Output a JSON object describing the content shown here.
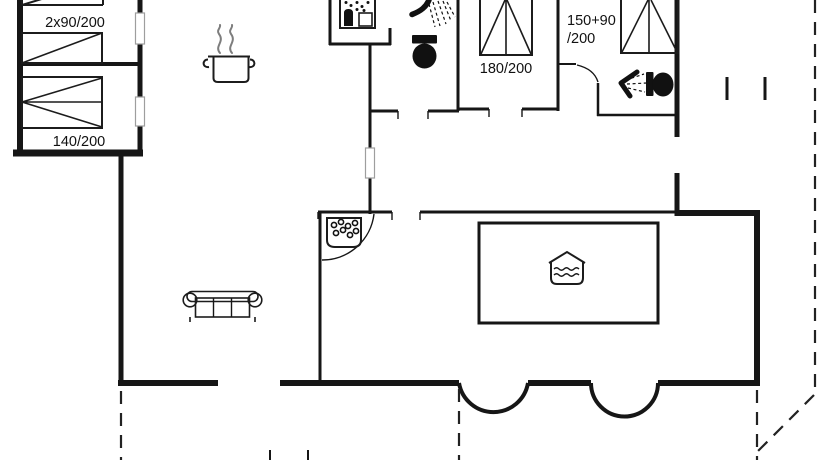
{
  "plan": {
    "type": "holiday-house floor plan",
    "labels": {
      "bed_two_singles": "2x90/200",
      "bed_double_140": "140/200",
      "bed_double_180": "180/200",
      "bed_family_line1": "150+90",
      "bed_family_line2": "/200"
    },
    "colors": {
      "background": "#ffffff",
      "wall": "#161616",
      "window_outline": "#9e9e9e",
      "steam_gray": "#7d7d7d"
    },
    "icons": [
      "washing-machine-icon",
      "shower-icon",
      "toilet-icon",
      "cooking-pot-icon",
      "corner-whirlpool-icon",
      "swimming-pool-icon",
      "sofa-icon",
      "single-bed-icon",
      "double-bed-icon"
    ]
  }
}
